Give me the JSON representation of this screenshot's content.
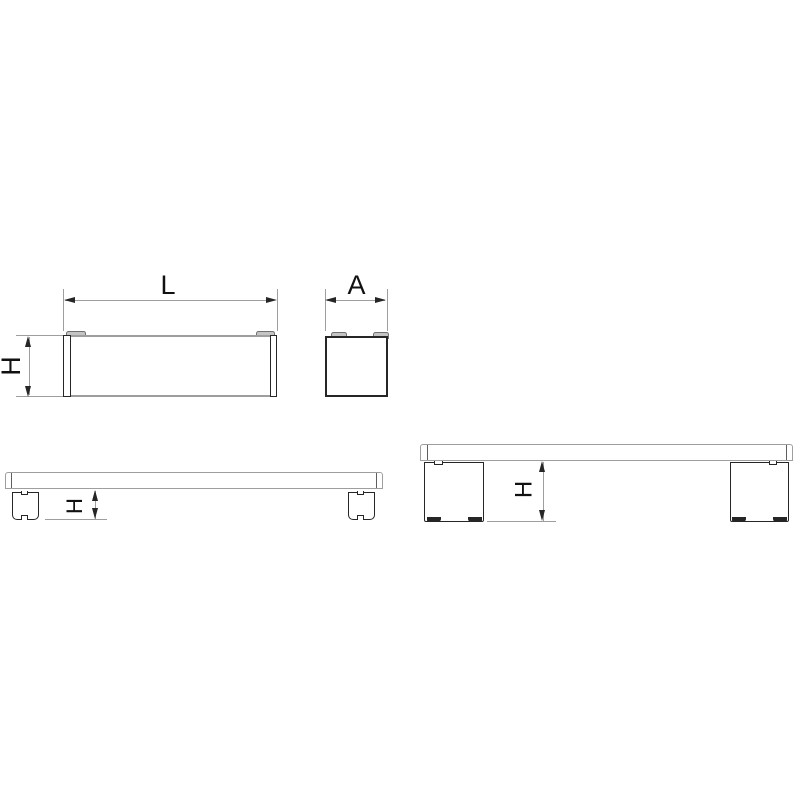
{
  "labels": {
    "front_length": "L",
    "front_height": "H",
    "side_width": "A",
    "elevation_short_height": "H",
    "elevation_tall_height": "H"
  },
  "colors": {
    "background": "#ffffff",
    "line_gray": "#9e9e9e",
    "line_medium": "#5f5f5f",
    "line_dark": "#262626",
    "tab_fill": "#c4c4c4",
    "tab_edge": "#707070",
    "text": "#111111"
  }
}
